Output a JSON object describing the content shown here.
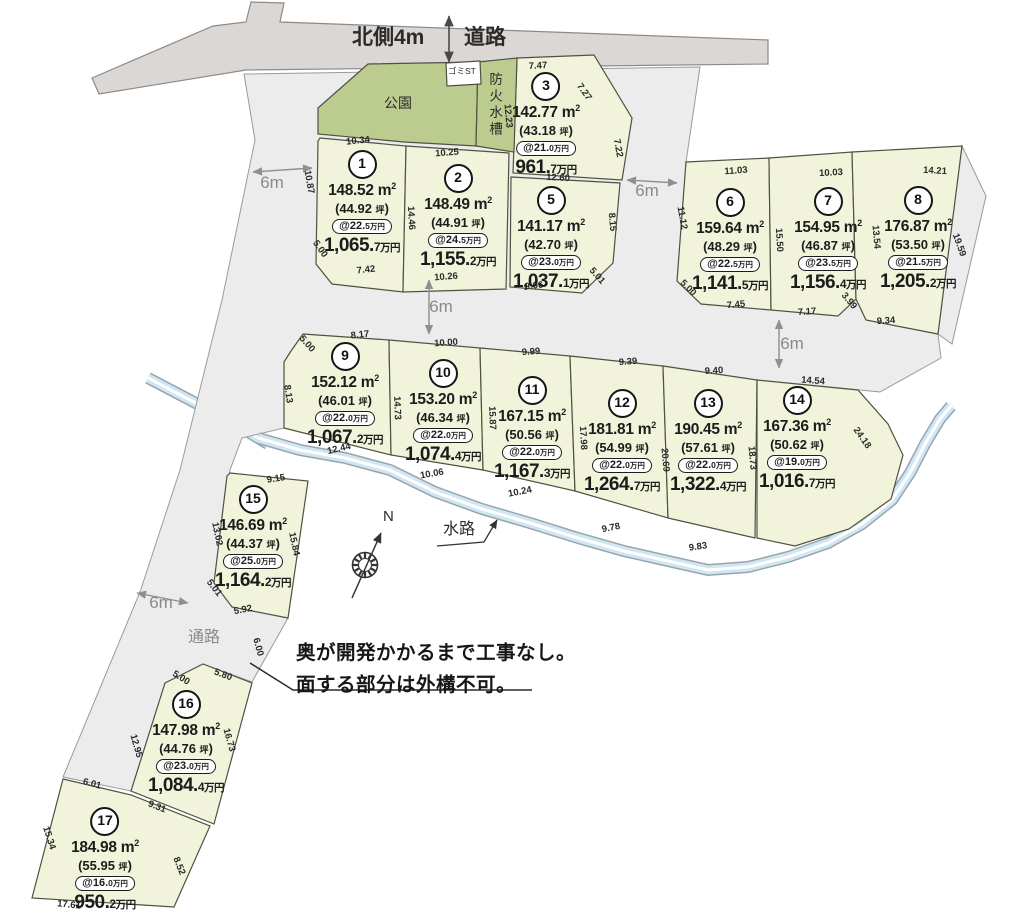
{
  "road": {
    "north_label": "北側4m",
    "road_label": "道路"
  },
  "features": {
    "park": "公園",
    "garbage_station": "ゴミST",
    "fire_tank": "防火水槽",
    "waterway": "水路",
    "passage": "通路"
  },
  "compass": {
    "north": "N"
  },
  "note": {
    "line1": "奥が開発かかるまで工事なし。",
    "line2": "面する部分は外構不可。"
  },
  "units": {
    "sqm": "m",
    "sqm_sup": "2",
    "tsubo": "坪",
    "man_en": "万円"
  },
  "colors": {
    "lot_fill": "#f1f4da",
    "park_fill": "#bccc8e",
    "road_fill": "#dbd7d5",
    "area_fill": "#ececec",
    "stream_fill": "#cfe6f5",
    "border": "#4f5142"
  },
  "width_labels": [
    {
      "text": "6m",
      "x": 272,
      "y": 183
    },
    {
      "text": "6m",
      "x": 647,
      "y": 191
    },
    {
      "text": "6m",
      "x": 441,
      "y": 307
    },
    {
      "text": "6m",
      "x": 792,
      "y": 344
    },
    {
      "text": "6m",
      "x": 161,
      "y": 603
    }
  ],
  "lots": [
    {
      "no": "1",
      "m2": "148.52",
      "tsubo": "44.92",
      "u": "@22.",
      "ud": "5",
      "p": "1,065.",
      "pd": "7",
      "x": 362,
      "y": 150
    },
    {
      "no": "2",
      "m2": "148.49",
      "tsubo": "44.91",
      "u": "@24.",
      "ud": "5",
      "p": "1,155.",
      "pd": "2",
      "x": 458,
      "y": 164
    },
    {
      "no": "3",
      "m2": "142.77",
      "tsubo": "43.18",
      "u": "@21.",
      "ud": "0",
      "p": "961.",
      "pd": "7",
      "x": 546,
      "y": 72
    },
    {
      "no": "5",
      "m2": "141.17",
      "tsubo": "42.70",
      "u": "@23.",
      "ud": "0",
      "p": "1,037.",
      "pd": "1",
      "x": 551,
      "y": 186
    },
    {
      "no": "6",
      "m2": "159.64",
      "tsubo": "48.29",
      "u": "@22.",
      "ud": "5",
      "p": "1,141.",
      "pd": "5",
      "x": 730,
      "y": 188
    },
    {
      "no": "7",
      "m2": "154.95",
      "tsubo": "46.87",
      "u": "@23.",
      "ud": "5",
      "p": "1,156.",
      "pd": "4",
      "x": 828,
      "y": 187
    },
    {
      "no": "8",
      "m2": "176.87",
      "tsubo": "53.50",
      "u": "@21.",
      "ud": "5",
      "p": "1,205.",
      "pd": "2",
      "x": 918,
      "y": 186
    },
    {
      "no": "9",
      "m2": "152.12",
      "tsubo": "46.01",
      "u": "@22.",
      "ud": "0",
      "p": "1,067.",
      "pd": "2",
      "x": 345,
      "y": 342
    },
    {
      "no": "10",
      "m2": "153.20",
      "tsubo": "46.34",
      "u": "@22.",
      "ud": "0",
      "p": "1,074.",
      "pd": "4",
      "x": 443,
      "y": 359
    },
    {
      "no": "11",
      "m2": "167.15",
      "tsubo": "50.56",
      "u": "@22.",
      "ud": "0",
      "p": "1,167.",
      "pd": "3",
      "x": 532,
      "y": 376
    },
    {
      "no": "12",
      "m2": "181.81",
      "tsubo": "54.99",
      "u": "@22.",
      "ud": "0",
      "p": "1,264.",
      "pd": "7",
      "x": 622,
      "y": 389
    },
    {
      "no": "13",
      "m2": "190.45",
      "tsubo": "57.61",
      "u": "@22.",
      "ud": "0",
      "p": "1,322.",
      "pd": "4",
      "x": 708,
      "y": 389
    },
    {
      "no": "14",
      "m2": "167.36",
      "tsubo": "50.62",
      "u": "@19.",
      "ud": "0",
      "p": "1,016.",
      "pd": "7",
      "x": 797,
      "y": 386
    },
    {
      "no": "15",
      "m2": "146.69",
      "tsubo": "44.37",
      "u": "@25.",
      "ud": "0",
      "p": "1,164.",
      "pd": "2",
      "x": 253,
      "y": 485
    },
    {
      "no": "16",
      "m2": "147.98",
      "tsubo": "44.76",
      "u": "@23.",
      "ud": "0",
      "p": "1,084.",
      "pd": "4",
      "x": 186,
      "y": 690
    },
    {
      "no": "17",
      "m2": "184.98",
      "tsubo": "55.95",
      "u": "@16.",
      "ud": "0",
      "p": "950.",
      "pd": "2",
      "x": 105,
      "y": 807
    }
  ],
  "dims": [
    [
      "10.34",
      358,
      141,
      -6
    ],
    [
      "10.25",
      447,
      153,
      -4
    ],
    [
      "7.47",
      538,
      66,
      -3
    ],
    [
      "7.27",
      584,
      92,
      55
    ],
    [
      "12.23",
      508,
      116,
      85
    ],
    [
      "7.22",
      618,
      148,
      80
    ],
    [
      "12.60",
      558,
      178,
      3
    ],
    [
      "10.87",
      309,
      182,
      80
    ],
    [
      "14.46",
      411,
      218,
      87
    ],
    [
      "8.15",
      612,
      222,
      85
    ],
    [
      "5.00",
      320,
      249,
      55
    ],
    [
      "7.42",
      366,
      270,
      -6
    ],
    [
      "10.26",
      446,
      277,
      -4
    ],
    [
      "9.06",
      534,
      286,
      -6
    ],
    [
      "5.01",
      597,
      276,
      48
    ],
    [
      "11.03",
      736,
      171,
      -4
    ],
    [
      "10.03",
      831,
      173,
      -3
    ],
    [
      "14.21",
      935,
      171,
      3
    ],
    [
      "11.12",
      682,
      218,
      80
    ],
    [
      "15.50",
      779,
      240,
      87
    ],
    [
      "13.54",
      876,
      237,
      85
    ],
    [
      "19.59",
      959,
      245,
      70
    ],
    [
      "5.00",
      688,
      288,
      45
    ],
    [
      "7.45",
      736,
      305,
      -5
    ],
    [
      "7.17",
      807,
      312,
      -4
    ],
    [
      "3.99",
      849,
      301,
      50
    ],
    [
      "9.34",
      886,
      321,
      -4
    ],
    [
      "8.17",
      360,
      335,
      -6
    ],
    [
      "5.00",
      307,
      344,
      48
    ],
    [
      "10.00",
      446,
      343,
      -4
    ],
    [
      "9.99",
      531,
      352,
      -4
    ],
    [
      "9.39",
      628,
      362,
      -4
    ],
    [
      "9.40",
      714,
      371,
      -3
    ],
    [
      "14.54",
      813,
      381,
      4
    ],
    [
      "8.13",
      288,
      394,
      82
    ],
    [
      "14.73",
      397,
      408,
      88
    ],
    [
      "15.87",
      492,
      418,
      88
    ],
    [
      "17.98",
      583,
      438,
      87
    ],
    [
      "20.69",
      665,
      460,
      85
    ],
    [
      "18.73",
      752,
      458,
      85
    ],
    [
      "24.18",
      862,
      438,
      55
    ],
    [
      "12.44",
      339,
      449,
      -13
    ],
    [
      "10.06",
      432,
      474,
      -10
    ],
    [
      "10.24",
      520,
      492,
      -11
    ],
    [
      "9.78",
      611,
      528,
      -11
    ],
    [
      "9.83",
      698,
      547,
      -8
    ],
    [
      "9.15",
      276,
      479,
      -9
    ],
    [
      "13.02",
      217,
      534,
      78
    ],
    [
      "15.84",
      294,
      544,
      78
    ],
    [
      "5.01",
      214,
      588,
      52
    ],
    [
      "5.92",
      243,
      610,
      -11
    ],
    [
      "6.00",
      258,
      647,
      75
    ],
    [
      "5.00",
      181,
      678,
      32
    ],
    [
      "5.80",
      223,
      675,
      20
    ],
    [
      "12.95",
      136,
      746,
      74
    ],
    [
      "16.73",
      229,
      740,
      74
    ],
    [
      "9.31",
      157,
      807,
      21
    ],
    [
      "6.01",
      92,
      784,
      15
    ],
    [
      "15.34",
      49,
      838,
      72
    ],
    [
      "8.52",
      179,
      866,
      68
    ],
    [
      "17.61",
      69,
      905,
      6
    ]
  ]
}
